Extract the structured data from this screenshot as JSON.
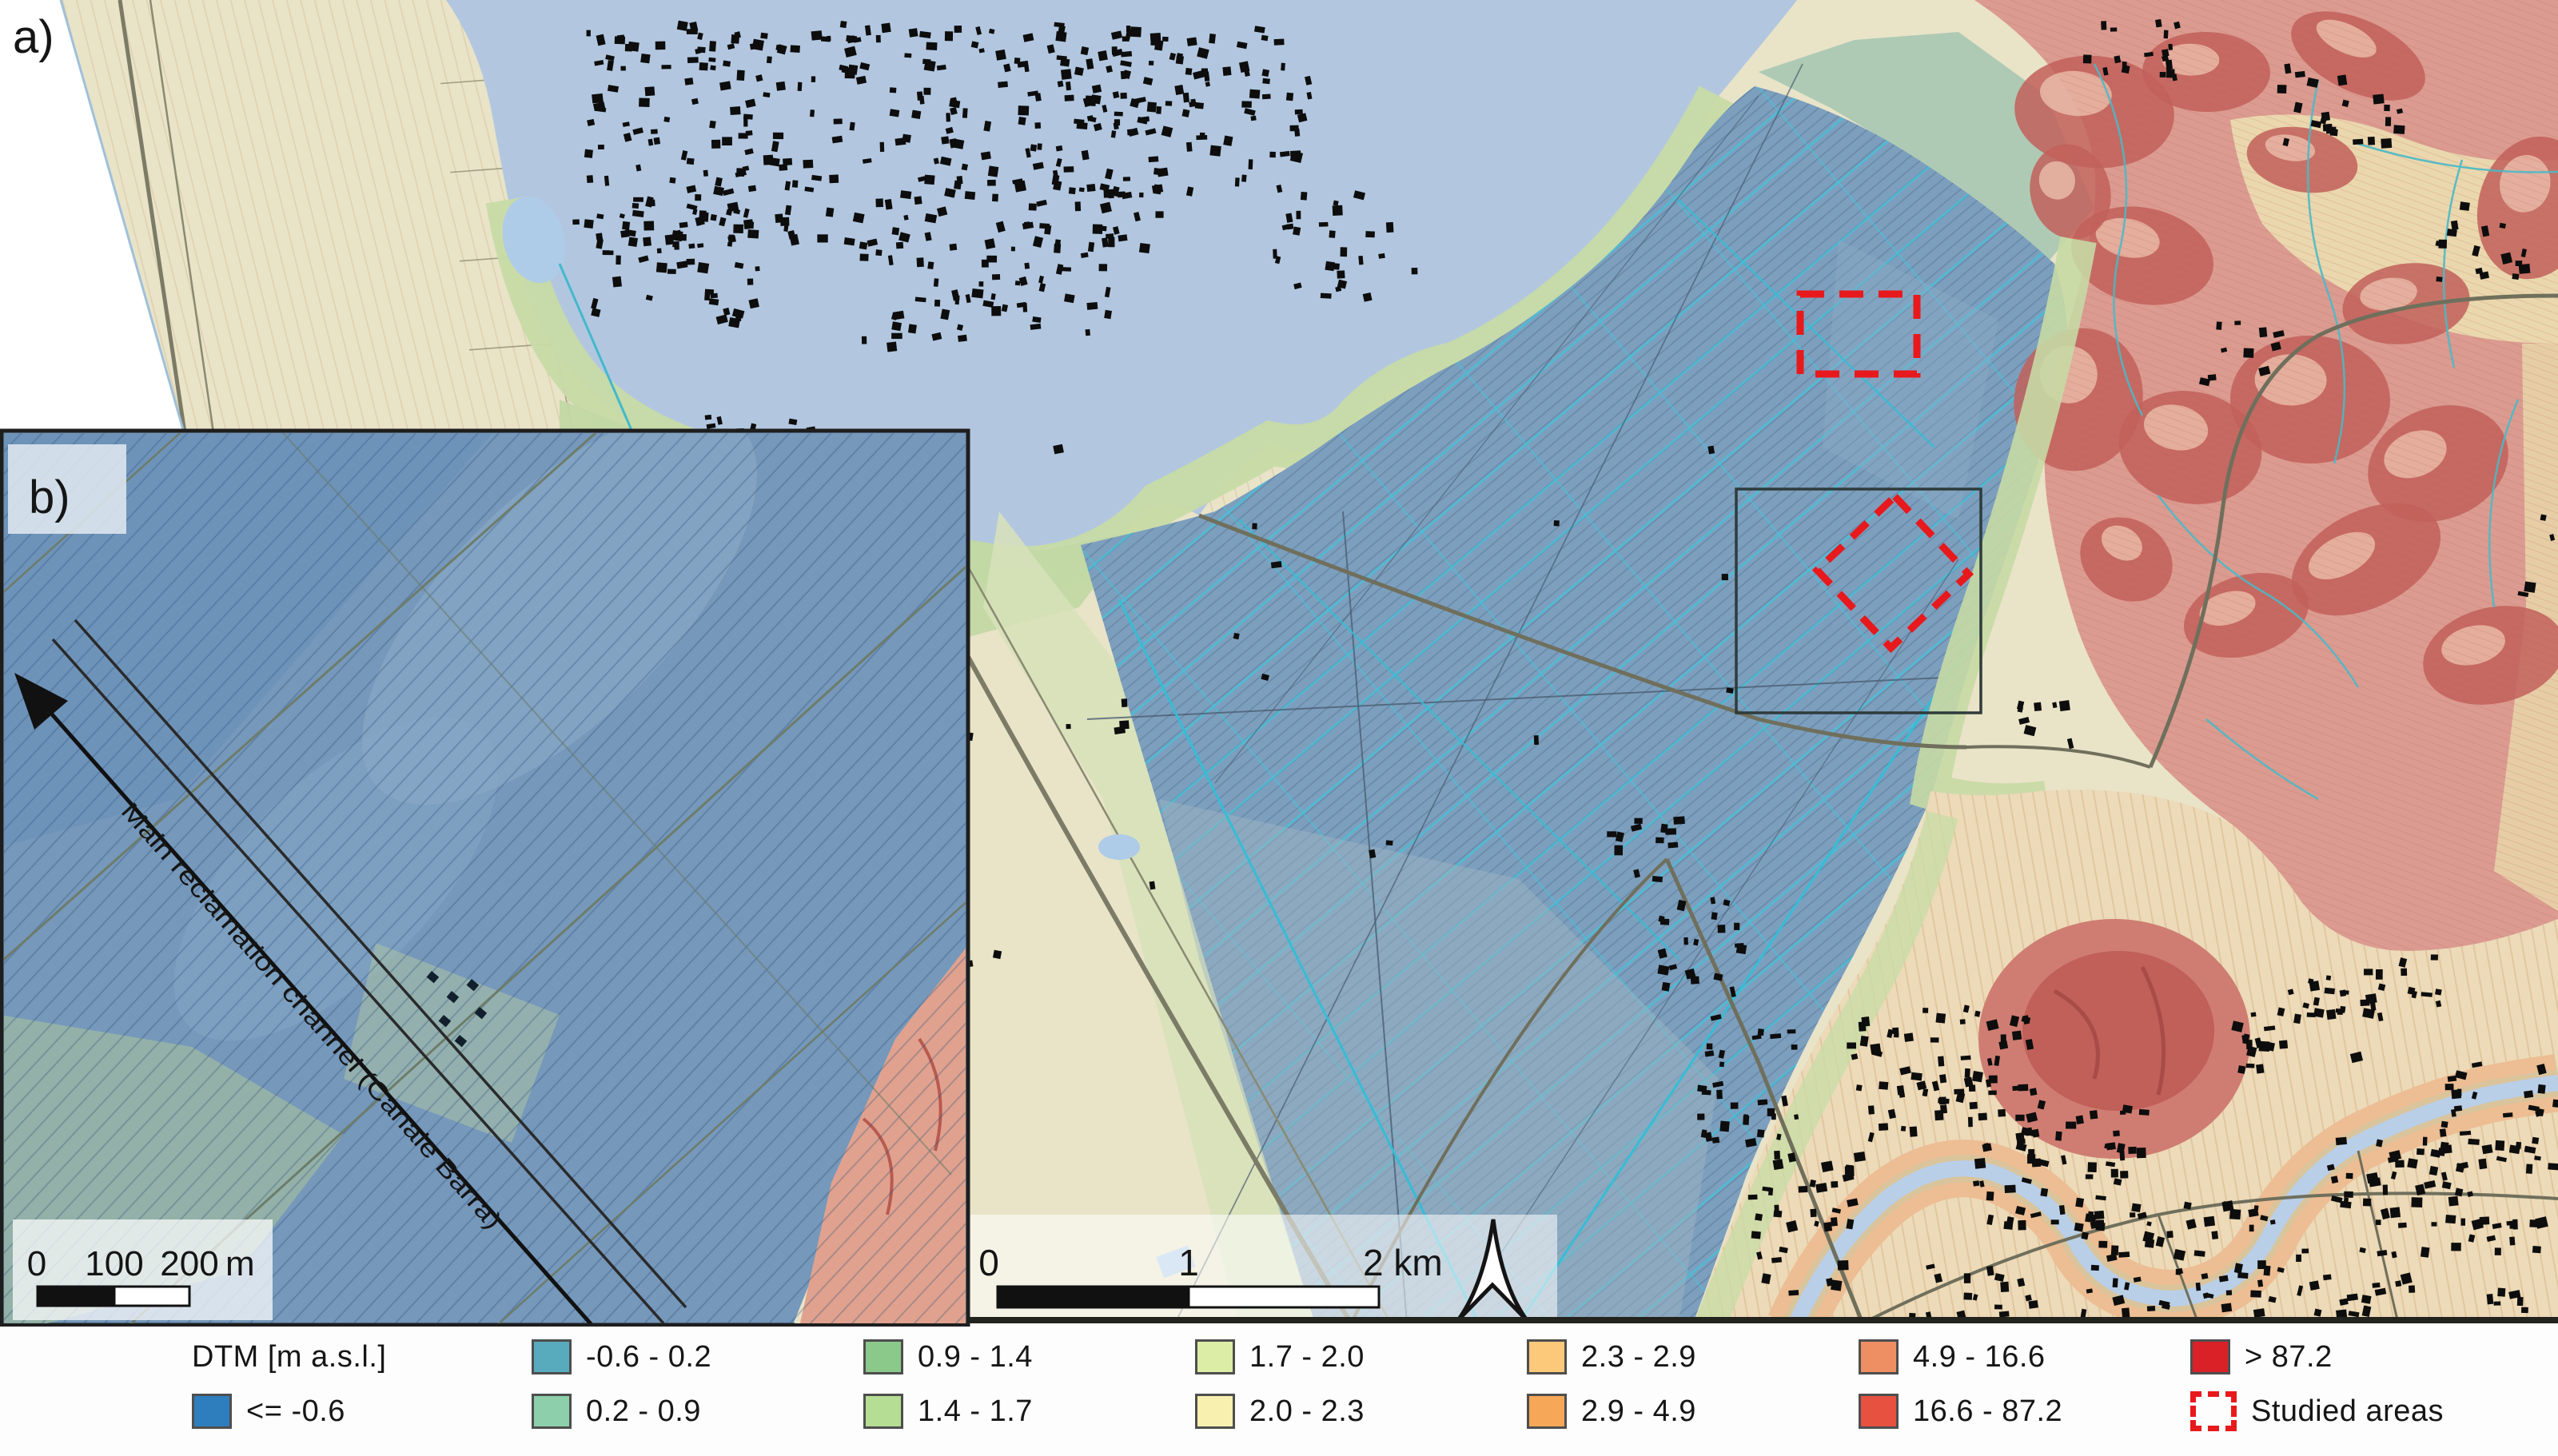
{
  "figure": {
    "panel_a_label": "a)",
    "panel_b_label": "b)"
  },
  "inset": {
    "channel_label": "Main reclamation channel (Canale Barra)",
    "scalebar": {
      "ticks": [
        "0",
        "100",
        "200"
      ],
      "unit": "m"
    }
  },
  "main_map": {
    "scalebar": {
      "ticks": [
        "0",
        "1",
        "2 km"
      ]
    }
  },
  "legend": {
    "title": "DTM [m a.s.l.]",
    "entries": [
      {
        "label": "<= -0.6",
        "color": "#2e7ebe"
      },
      {
        "label": "-0.6 - 0.2",
        "color": "#58abbc"
      },
      {
        "label": "0.2 - 0.9",
        "color": "#8ecfab"
      },
      {
        "label": "0.9 - 1.4",
        "color": "#8bc98b"
      },
      {
        "label": "1.4 - 1.7",
        "color": "#b5dd94"
      },
      {
        "label": "1.7 - 2.0",
        "color": "#dceda6"
      },
      {
        "label": "2.0 - 2.3",
        "color": "#f7f0af"
      },
      {
        "label": "2.3 - 2.9",
        "color": "#fcc97b"
      },
      {
        "label": "2.9 - 4.9",
        "color": "#f7a758"
      },
      {
        "label": "4.9 - 16.6",
        "color": "#ee8f63"
      },
      {
        "label": "16.6 - 87.2",
        "color": "#e65140"
      },
      {
        "label": "> 87.2",
        "color": "#da2127"
      }
    ],
    "studied_areas": {
      "label": "Studied areas",
      "color": "#e8191c"
    }
  },
  "map_colors": {
    "lagoon_water": "#b2c7df",
    "reclaimed_basin": "#7d9fbe",
    "hills": "#db9b90",
    "alluvial_plain": "#ecdab8",
    "studied_area_outline": "#e8191c"
  }
}
